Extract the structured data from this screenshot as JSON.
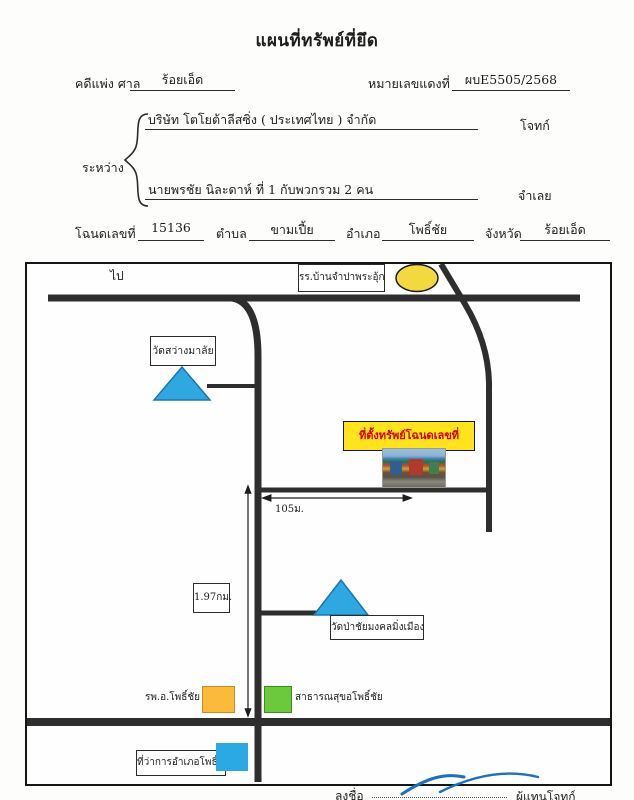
{
  "document": {
    "title": "แผนที่ทรัพย์ที่ยึด",
    "case_line": {
      "label": "คดีแพ่ง ศาล",
      "court": "ร้อยเอ็ด",
      "red_label": "หมายเลขแดงที่",
      "red_no": "ผบE5505/2568"
    },
    "between_label": "ระหว่าง",
    "plaintiff": {
      "name": "บริษัท โตโยต้าลีสซิ่ง ( ประเทศไทย ) จำกัด",
      "role": "โจทก์"
    },
    "defendant": {
      "name": "นายพรชัย นิละดาห์ ที่ 1 กับพวกรวม 2 คน",
      "role": "จำเลย"
    },
    "deed": {
      "label": "โฉนดเลขที่",
      "no": "15136",
      "subdistrict_label": "ตำบล",
      "subdistrict": "ขามเปี้ย",
      "district_label": "อำเภอ",
      "district": "โพธิ์ชัย",
      "province_label": "จังหวัด",
      "province": "ร้อยเอ็ด"
    }
  },
  "map": {
    "direction_label": "ไป",
    "school_label": "รร.บ้านจำปาพระอุ้ก",
    "temple1_label": "วัดสว่างมาลัย",
    "property_label": "ที่ตั้งทรัพย์โฉนดเลขที่ 15136",
    "distance_horizontal": "105ม.",
    "distance_vertical": "1.97กม.",
    "temple2_label": "วัดป่าชัยมงคลมิ่งเมือง",
    "hospital_label": "รพ.อ.โพธิ์ชัย",
    "health_office_label": "สาธารณสุขอโพธิ์ชัย",
    "district_office_label": "ที่ว่าการอำเภอโพธิ์ชัย"
  },
  "footer": {
    "sign_label": "ลงชื่อ",
    "signer_role": "ผู้แทนโจทก์"
  },
  "colors": {
    "road": "#2e2e2e",
    "school_ellipse": "#f3d93f",
    "temple_triangle": "#2fa7e0",
    "triangle_border": "#1779ad",
    "property_box_bg": "#ffe41d",
    "property_box_text": "#d40000",
    "hospital_rect": "#fbba3c",
    "health_rect": "#6cc93e",
    "district_rect": "#2aa9e4",
    "signature": "#1d6fc0"
  }
}
